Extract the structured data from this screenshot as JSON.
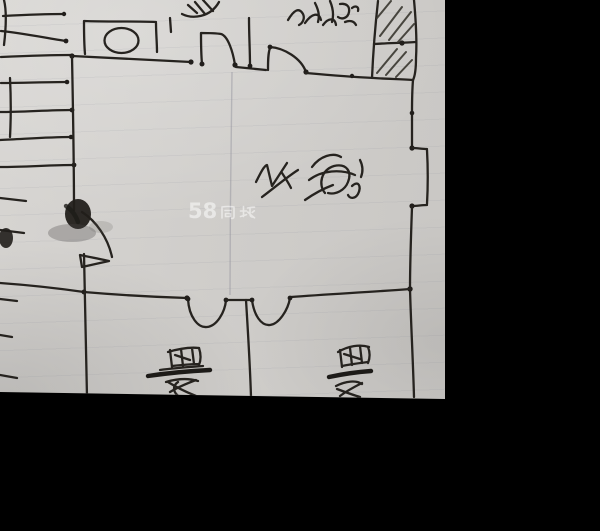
{
  "scene": {
    "description": "Photograph of a hand-drawn floor-plan sketch on grey lined paper, letterboxed on black",
    "background_color": "#000000",
    "paper_color": "#d0cecb",
    "ink_color": "#26231f",
    "photo_area": {
      "left": 0,
      "top": 0,
      "width": 445,
      "height": 397
    }
  },
  "watermark": {
    "full_text": "58同城",
    "number": "58",
    "suffix": "同城",
    "color": "#ffffff",
    "position": "center of image"
  },
  "labels": {
    "living_room": {
      "text": "客厅",
      "legibility": "low",
      "style": "rotated cursive handwriting, center of large room"
    },
    "top_right_room": {
      "text": "卧室",
      "legibility": "illegible scribble",
      "style": "rotated handwriting, cut by top edge"
    },
    "bottom_left_room": {
      "text": "厨房",
      "legibility": "illegible scribble",
      "style": "rotated handwriting with heavy underline, cut by bottom edge"
    },
    "bottom_right_room": {
      "text": "卧室",
      "legibility": "illegible scribble",
      "style": "rotated handwriting with heavy underline, cut by bottom edge"
    }
  },
  "plan_features": {
    "staircase": "hatched stair treads along the left edge, two flights, ink smudge blobs at the foot",
    "bathroom_fixture": "rectangle with oval (tub) in small top-left room",
    "top_fixture": "scribbled fixture cut by top edge",
    "doors": "two arched door openings on top wall, swing-arc door below stairs, two U-arc doors on bottom wall",
    "window": "double-line window bump on right wall",
    "hatched_shaft": "diagonally hatched column in the top-right corner of the plan"
  }
}
